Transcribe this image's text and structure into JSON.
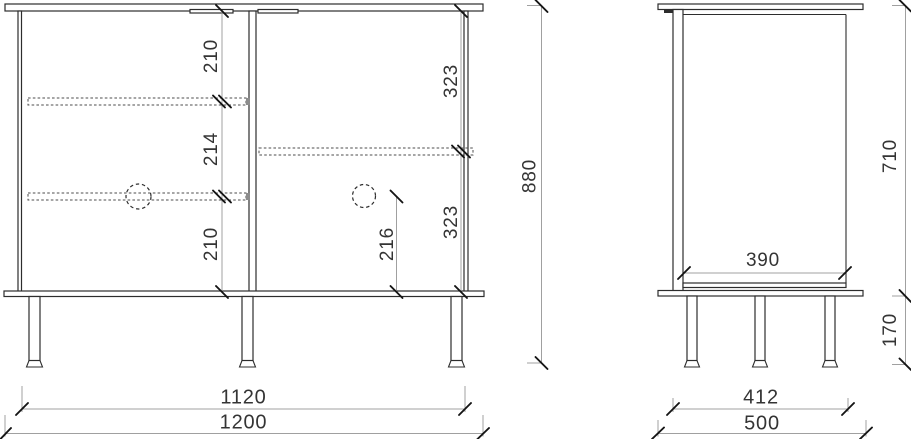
{
  "colors": {
    "background": "#ffffff",
    "outline": "#2d2d2d",
    "hidden": "#4d4d4d",
    "dim": "#a0a0a0",
    "tick": "#141414",
    "text": "#343434",
    "cap": "#8c8c8c"
  },
  "front_view": {
    "shelf_dims": [
      "210",
      "214",
      "210"
    ],
    "door_dims": [
      "323",
      "323"
    ],
    "knob_height": "216",
    "overall_height": "880",
    "inner_width": "1120",
    "overall_width": "1200"
  },
  "side_view": {
    "body_height": "710",
    "inner_depth": "390",
    "leg_height": "170",
    "leg_span": "412",
    "overall_depth": "500"
  }
}
